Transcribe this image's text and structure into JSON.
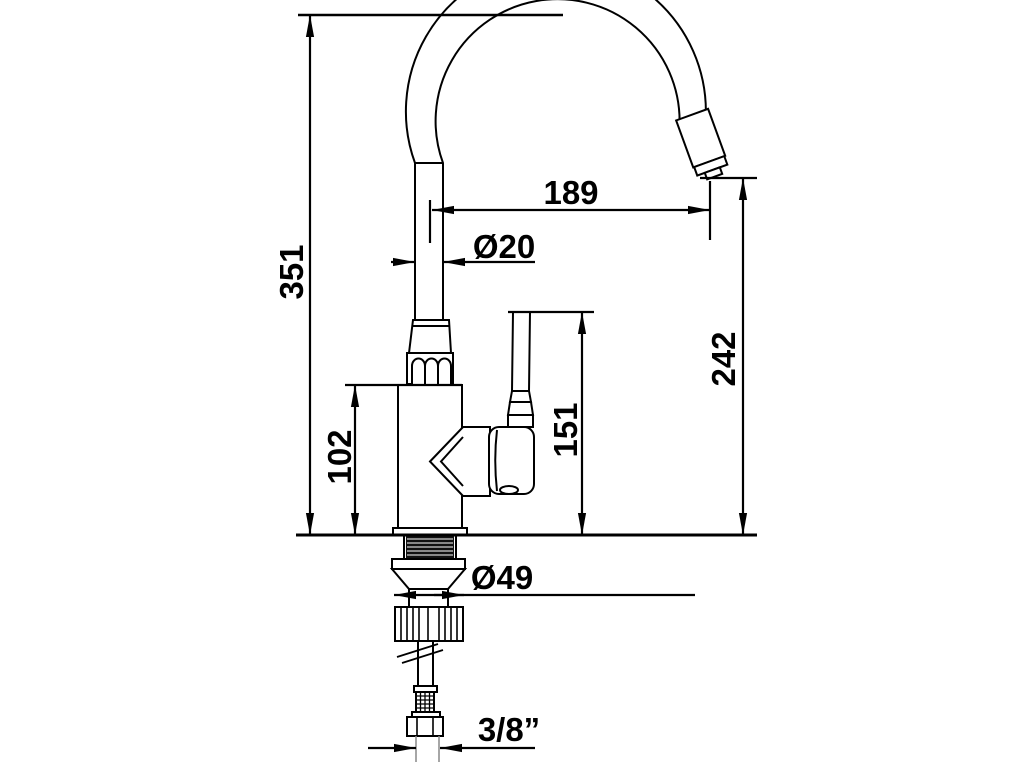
{
  "page": {
    "background": "#ffffff",
    "line_color": "#000000",
    "title": "Faucet installation dimension drawing"
  },
  "labels": {
    "overall_height": "351",
    "spout_reach": "189",
    "spout_diameter": "Ø20",
    "outlet_height": "242",
    "handle_height": "151",
    "body_height": "102",
    "base_diameter": "Ø49",
    "connection_size": "3/8”"
  }
}
